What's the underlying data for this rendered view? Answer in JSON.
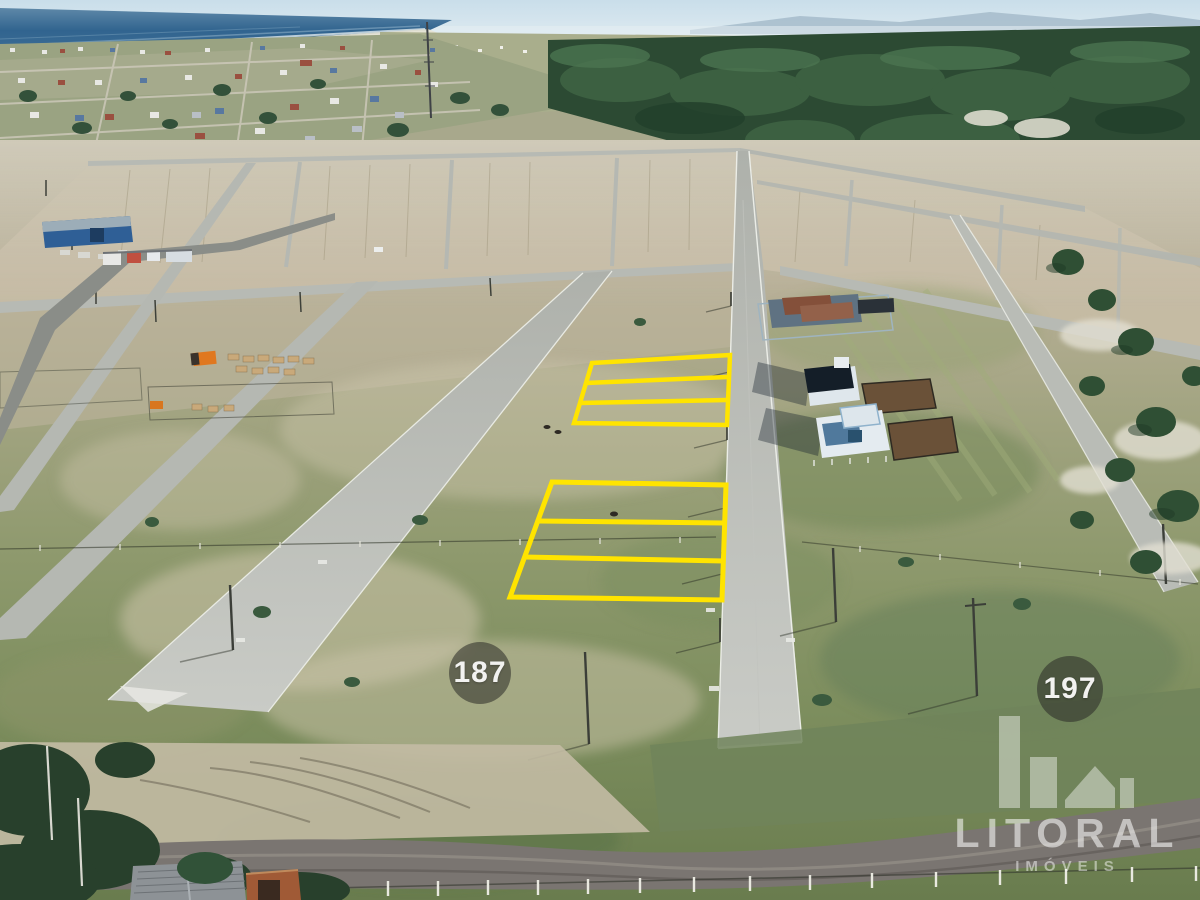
{
  "image": {
    "kind": "aerial-drone-photo",
    "subject": "beachside land subdivision with paved streets, empty staked lots, houses under construction, ocean and town in the distance",
    "highlighted_lot_groups": [
      {
        "name": "upper-group",
        "lots": 3,
        "location": "left of main street, mid-field"
      },
      {
        "name": "lower-group",
        "lots": 3,
        "location": "left of main street, foreground"
      }
    ],
    "highlight_color": "#FFE400"
  },
  "markers": {
    "left": {
      "label": "187"
    },
    "right": {
      "label": "197"
    }
  },
  "watermark": {
    "brand": "LITORAL",
    "tagline": "IMÓVEIS"
  },
  "palette": {
    "sky": "#d3e4ee",
    "sea": "#31648f",
    "forest": "#2c4a33",
    "dirt_blocks": "#c6bca4",
    "grass": "#7f9060",
    "road": "#b7bab4",
    "gravel_road": "#7a7571",
    "badge_bg": "rgba(42,42,38,0.55)",
    "watermark_white": "rgba(255,255,255,0.5)"
  }
}
